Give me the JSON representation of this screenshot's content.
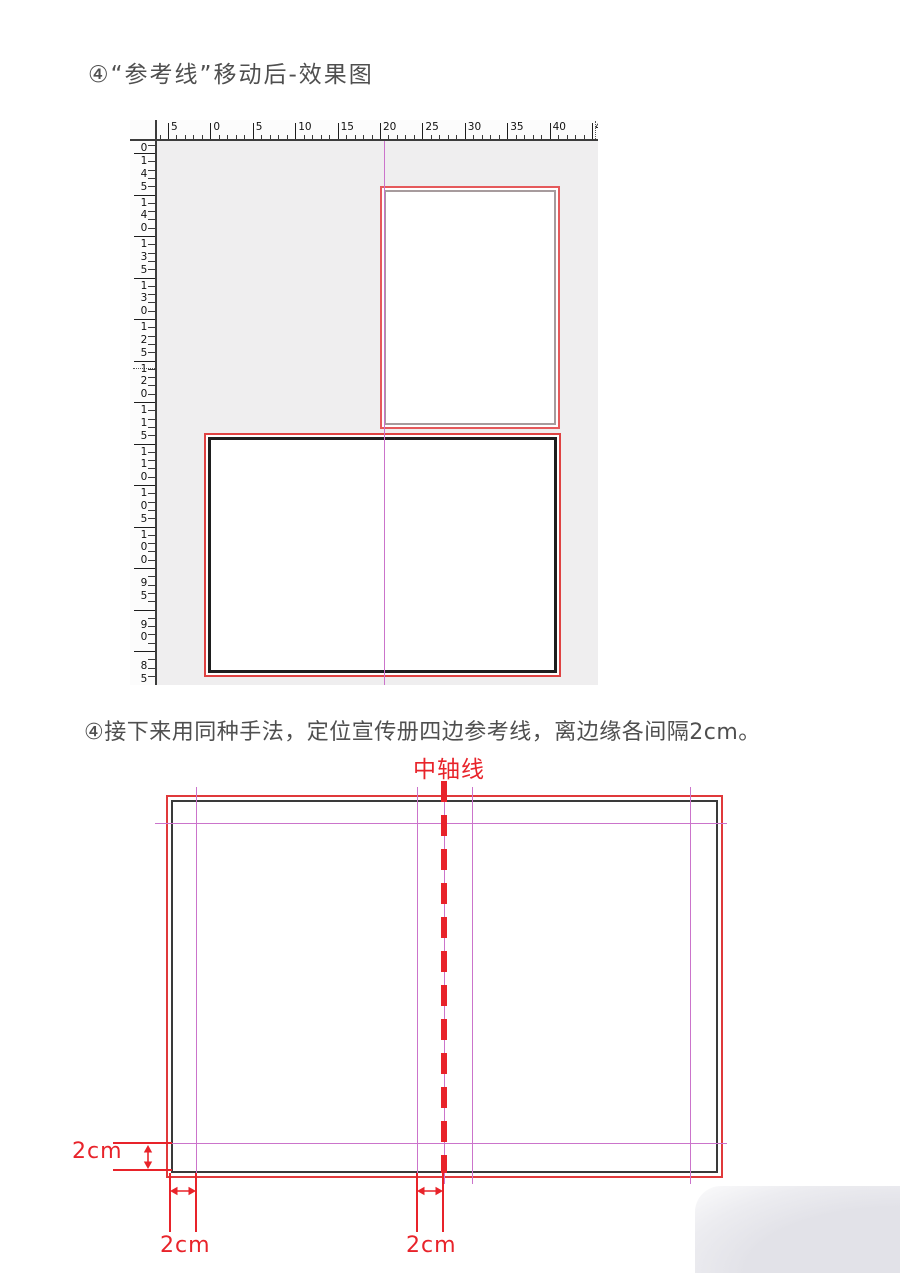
{
  "colors": {
    "title_text": "#4f4f4f",
    "rect_red": "#e0393b",
    "annotation_red": "#e8232a",
    "guide_purple": "#cb74cb",
    "gray_border": "#a79b9d",
    "dark_border": "#1e1e1e",
    "canvas_bg": "#efeeef",
    "ruler_bg": "#fcfcfc"
  },
  "section1": {
    "title": "④“参考线”移动后-效果图",
    "horizontal_ruler_labels": [
      "5",
      "0",
      "5",
      "10",
      "15",
      "20",
      "25",
      "30",
      "35",
      "40",
      "45"
    ],
    "vertical_ruler_labels": [
      "0",
      "145",
      "140",
      "135",
      "130",
      "125",
      "120",
      "115",
      "110",
      "105",
      "100",
      "95",
      "90",
      "85"
    ]
  },
  "section2": {
    "title": "④接下来用同种手法，定位宣传册四边参考线，离边缘各间隔2cm。",
    "axis_label": "中轴线",
    "dim_left_label": "2cm",
    "dim_bottom_left_label": "2cm",
    "dim_bottom_center_label": "2cm"
  }
}
